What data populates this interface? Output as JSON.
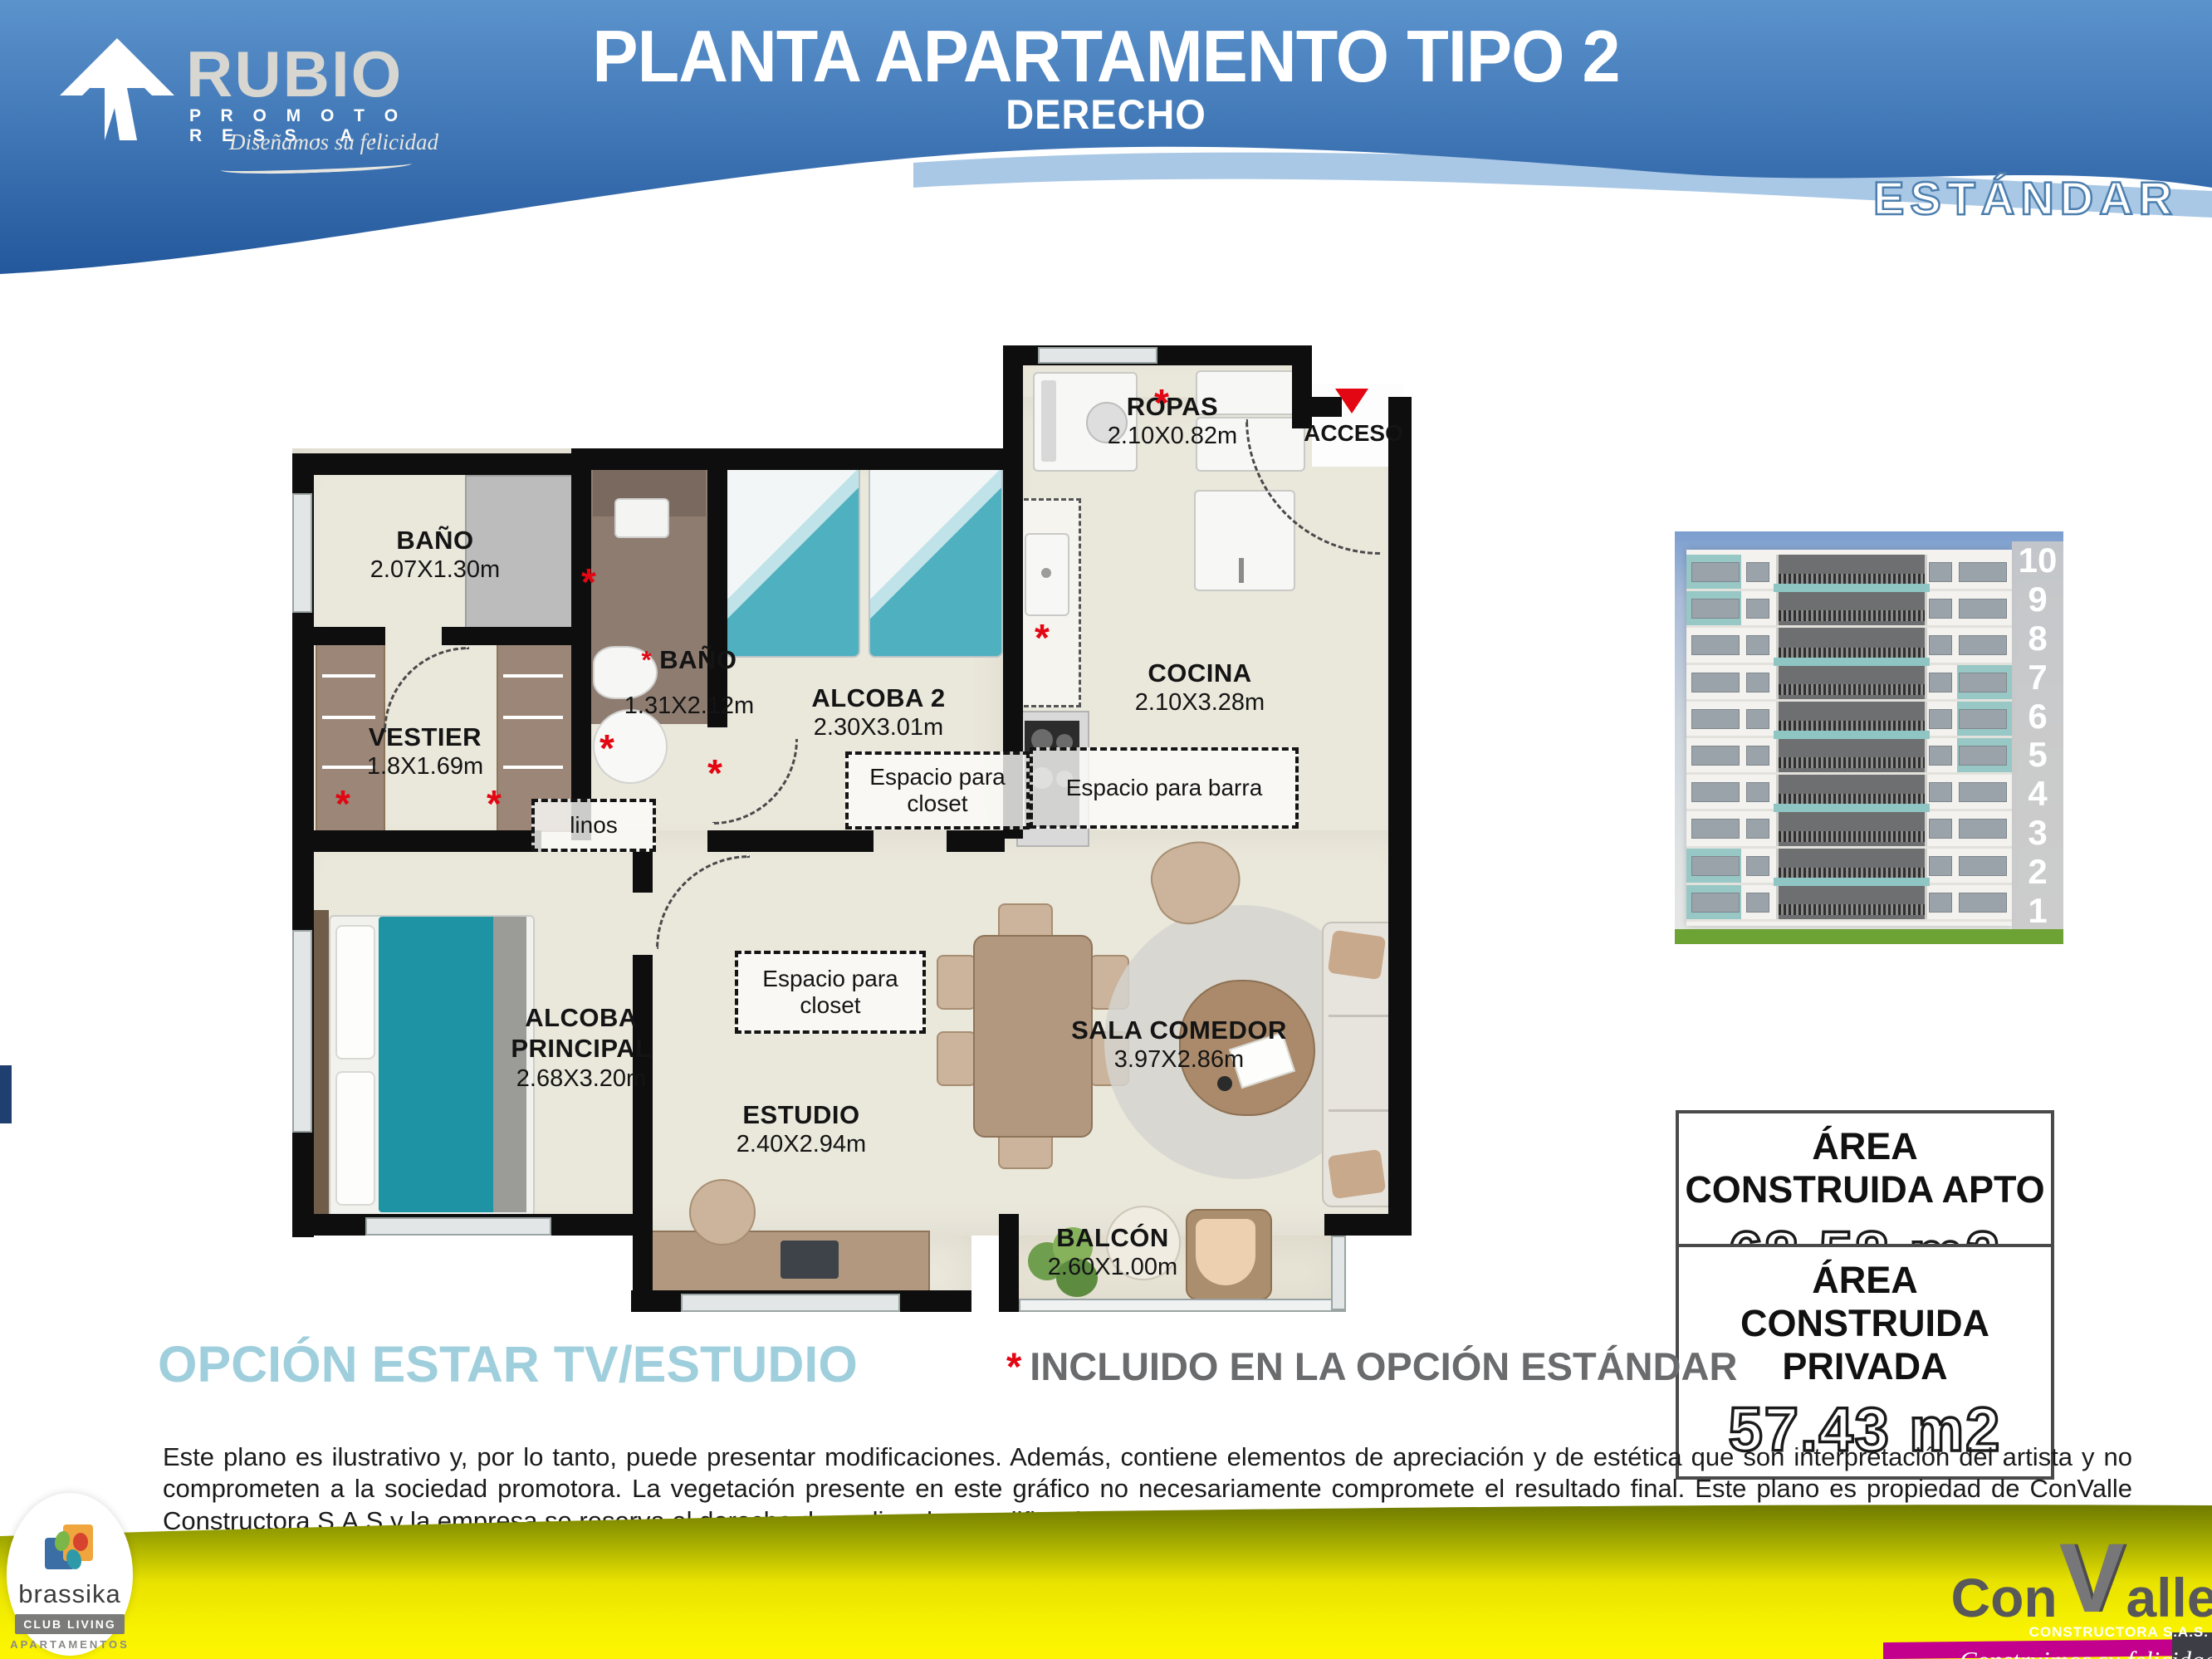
{
  "header": {
    "brand": {
      "name": "RUBIO",
      "sub": "P R O M O T O R E S  S . A .",
      "tagline": "Diseñamos su felicidad"
    },
    "title": "PLANTA APARTAMENTO TIPO 2",
    "subtitle": "DERECHO"
  },
  "variant_label": "ESTÁNDAR",
  "sym": {
    "asterisk": "*"
  },
  "floorplan": {
    "access_label": "ACCESO",
    "rooms": [
      {
        "name": "ROPAS",
        "dims": "2.10X0.82m"
      },
      {
        "name": "BAÑO",
        "dims": "2.07X1.30m"
      },
      {
        "name": "VESTIER",
        "dims": "1.8X1.69m"
      },
      {
        "name": "BAÑO",
        "dims": "1.31X2.12m"
      },
      {
        "name": "ALCOBA 2",
        "dims": "2.30X3.01m"
      },
      {
        "name": "COCINA",
        "dims": "2.10X3.28m"
      },
      {
        "name": "ALCOBA PRINCIPAL",
        "dims": "2.68X3.20m"
      },
      {
        "name": "ESTUDIO",
        "dims": "2.40X2.94m"
      },
      {
        "name": "SALA COMEDOR",
        "dims": "3.97X2.86m"
      },
      {
        "name": "BALCÓN",
        "dims": "2.60X1.00m"
      }
    ],
    "zones": [
      {
        "label": "Espacio para closet"
      },
      {
        "label": "Espacio para barra"
      },
      {
        "label": "Espacio para closet"
      },
      {
        "label": "linos"
      }
    ]
  },
  "building": {
    "floors": [
      "10",
      "9",
      "8",
      "7",
      "6",
      "5",
      "4",
      "3",
      "2",
      "1"
    ]
  },
  "areas": [
    {
      "title": "ÁREA CONSTRUIDA APTO",
      "value": "68,58 m2"
    },
    {
      "title": "ÁREA CONSTRUIDA PRIVADA",
      "value": "57.43 m2"
    }
  ],
  "option_label": "OPCIÓN ESTAR TV/ESTUDIO",
  "included_note": "INCLUIDO EN LA OPCIÓN ESTÁNDAR",
  "disclaimer": "Este plano es ilustrativo y, por lo tanto, puede presentar modificaciones. Además, contiene elementos de apreciación y de estética que son interpretación del artista y no comprometen a la sociedad promotora. La vegetación presente en este gráfico no necesariamente compromete el resultado final. Este plano es propiedad de ConValle Constructora S.A.S y la empresa se reserva el derecho de realizar las modificaciones requeridas debido a ajustes estructurales o arquitectónicos.",
  "footer": {
    "brassika": {
      "name": "brassika",
      "badge": "CLUB LIVING",
      "sub": "APARTAMENTOS"
    },
    "convalle": {
      "part1": "Con",
      "part2": "V",
      "part3": "alle",
      "sub": "CONSTRUCTORA S.A.S.",
      "tagline": "Construimos su felicidad"
    }
  },
  "colors": {
    "header_blue": "#2f66a8",
    "accent_teal": "#8fc6c4",
    "option_cyan": "#9fcfdc",
    "asterisk_red": "#e30613",
    "footer_yellow": "#f2ea00",
    "magenta": "#c3008e",
    "wall_black": "#0e0e0e"
  }
}
